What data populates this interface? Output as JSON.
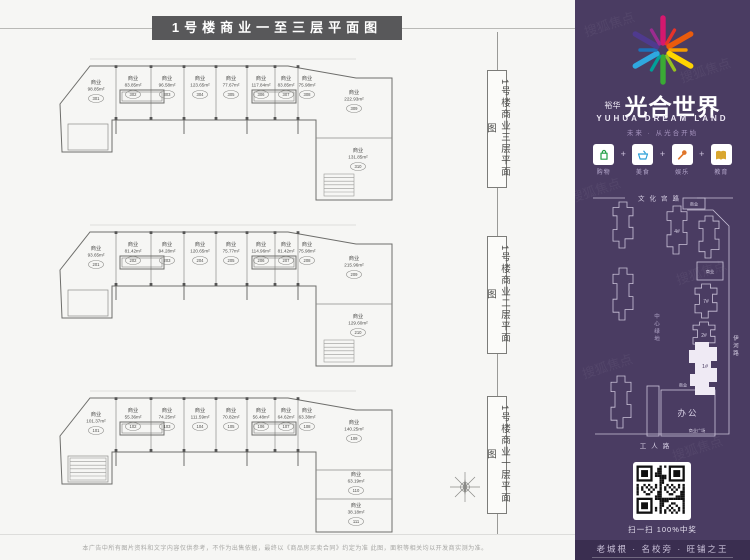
{
  "title": "1号楼商业一至三层平面图",
  "watermark": "搜狐焦点",
  "disclaimer": "本广告中所有图片资料和文字内容仅供参考，不作为出售依据，最终以《商品房买卖合同》约定为准 此图，面积等相关均以开发商实测为准。",
  "plans": [
    {
      "side_label": "1号楼商业三层平面图",
      "rooms": [
        {
          "label": "商业",
          "area": "98.85m²",
          "no": "301",
          "x": 40,
          "y": 38
        },
        {
          "label": "商业",
          "area": "83.85m²",
          "no": "302",
          "x": 77,
          "y": 34
        },
        {
          "label": "商业",
          "area": "96.58m²",
          "no": "303",
          "x": 111,
          "y": 34
        },
        {
          "label": "商业",
          "area": "123.65m²",
          "no": "304",
          "x": 144,
          "y": 34
        },
        {
          "label": "商业",
          "area": "77.67m²",
          "no": "305",
          "x": 175,
          "y": 34
        },
        {
          "label": "商业",
          "area": "117.84m²",
          "no": "306",
          "x": 205,
          "y": 34
        },
        {
          "label": "商业",
          "area": "83.85m²",
          "no": "307",
          "x": 230,
          "y": 34
        },
        {
          "label": "商业",
          "area": "75.98m²",
          "no": "308",
          "x": 251,
          "y": 34
        },
        {
          "label": "商业",
          "area": "222.93m²",
          "no": "309",
          "x": 298,
          "y": 48
        },
        {
          "label": "商业",
          "area": "131.85m²",
          "no": "310",
          "x": 302,
          "y": 106
        }
      ]
    },
    {
      "side_label": "1号楼商业二层平面图",
      "rooms": [
        {
          "label": "商业",
          "area": "93.65m²",
          "no": "201",
          "x": 40,
          "y": 38
        },
        {
          "label": "商业",
          "area": "81.42m²",
          "no": "202",
          "x": 77,
          "y": 34
        },
        {
          "label": "商业",
          "area": "94.28m²",
          "no": "203",
          "x": 111,
          "y": 34
        },
        {
          "label": "商业",
          "area": "120.65m²",
          "no": "204",
          "x": 144,
          "y": 34
        },
        {
          "label": "商业",
          "area": "75.77m²",
          "no": "205",
          "x": 175,
          "y": 34
        },
        {
          "label": "商业",
          "area": "114.96m²",
          "no": "206",
          "x": 205,
          "y": 34
        },
        {
          "label": "商业",
          "area": "81.42m²",
          "no": "207",
          "x": 230,
          "y": 34
        },
        {
          "label": "商业",
          "area": "75.98m²",
          "no": "208",
          "x": 251,
          "y": 34
        },
        {
          "label": "商业",
          "area": "215.96m²",
          "no": "209",
          "x": 298,
          "y": 48
        },
        {
          "label": "商业",
          "area": "129.60m²",
          "no": "210",
          "x": 302,
          "y": 106
        }
      ]
    },
    {
      "side_label": "1号楼商业一层平面图",
      "rooms": [
        {
          "label": "商业",
          "area": "101.37m²",
          "no": "101",
          "x": 40,
          "y": 38
        },
        {
          "label": "商业",
          "area": "55.36m²",
          "no": "102",
          "x": 77,
          "y": 34
        },
        {
          "label": "商业",
          "area": "74.25m²",
          "no": "103",
          "x": 111,
          "y": 34
        },
        {
          "label": "商业",
          "area": "111.59m²",
          "no": "104",
          "x": 144,
          "y": 34
        },
        {
          "label": "商业",
          "area": "70.82m²",
          "no": "105",
          "x": 175,
          "y": 34
        },
        {
          "label": "商业",
          "area": "56.48m²",
          "no": "106",
          "x": 205,
          "y": 34
        },
        {
          "label": "商业",
          "area": "64.62m²",
          "no": "107",
          "x": 230,
          "y": 34
        },
        {
          "label": "商业",
          "area": "63.38m²",
          "no": "108",
          "x": 251,
          "y": 34
        },
        {
          "label": "商业",
          "area": "140.25m²",
          "no": "109",
          "x": 298,
          "y": 46
        },
        {
          "label": "商业",
          "area": "63.19m²",
          "no": "110",
          "x": 300,
          "y": 98
        },
        {
          "label": "商业",
          "area": "38.18m²",
          "no": "111",
          "x": 300,
          "y": 129
        }
      ]
    }
  ],
  "sidebar": {
    "brand_prefix": "裕华",
    "brand": "光合世界",
    "brand_en": "YUHUA DREAM LAND",
    "slogan": "未来 · 从光合开始",
    "amenities": [
      {
        "label": "购物",
        "color": "#1f9e43"
      },
      {
        "label": "美食",
        "color": "#2b9fd8"
      },
      {
        "label": "娱乐",
        "color": "#e0762a"
      },
      {
        "label": "教育",
        "color": "#d9a62e"
      }
    ],
    "map": {
      "road_top": "文化宫路",
      "green_center": "中心绿地",
      "road_right": "伊河路",
      "road_bottom": "工人路",
      "b4": "4#",
      "b7": "7#",
      "b2": "2#",
      "b1": "1#",
      "biz": "商业",
      "office": "办公",
      "plaza": "商业广场"
    },
    "qr_caption": "扫一扫 100%中奖",
    "footer": "老城根 · 名校旁 · 旺铺之王"
  },
  "colors": {
    "sidebar": "#4a3c62",
    "sidebar_dark": "#3a2e50",
    "title_bg": "#58585a",
    "logo_rays": [
      "#d6186e",
      "#e6332a",
      "#ea5b0c",
      "#f59c00",
      "#ffd500",
      "#95c11f",
      "#3aaa35",
      "#00a099",
      "#2fa8e0",
      "#1d71b8",
      "#4f3a8e",
      "#9b2c8f"
    ]
  }
}
